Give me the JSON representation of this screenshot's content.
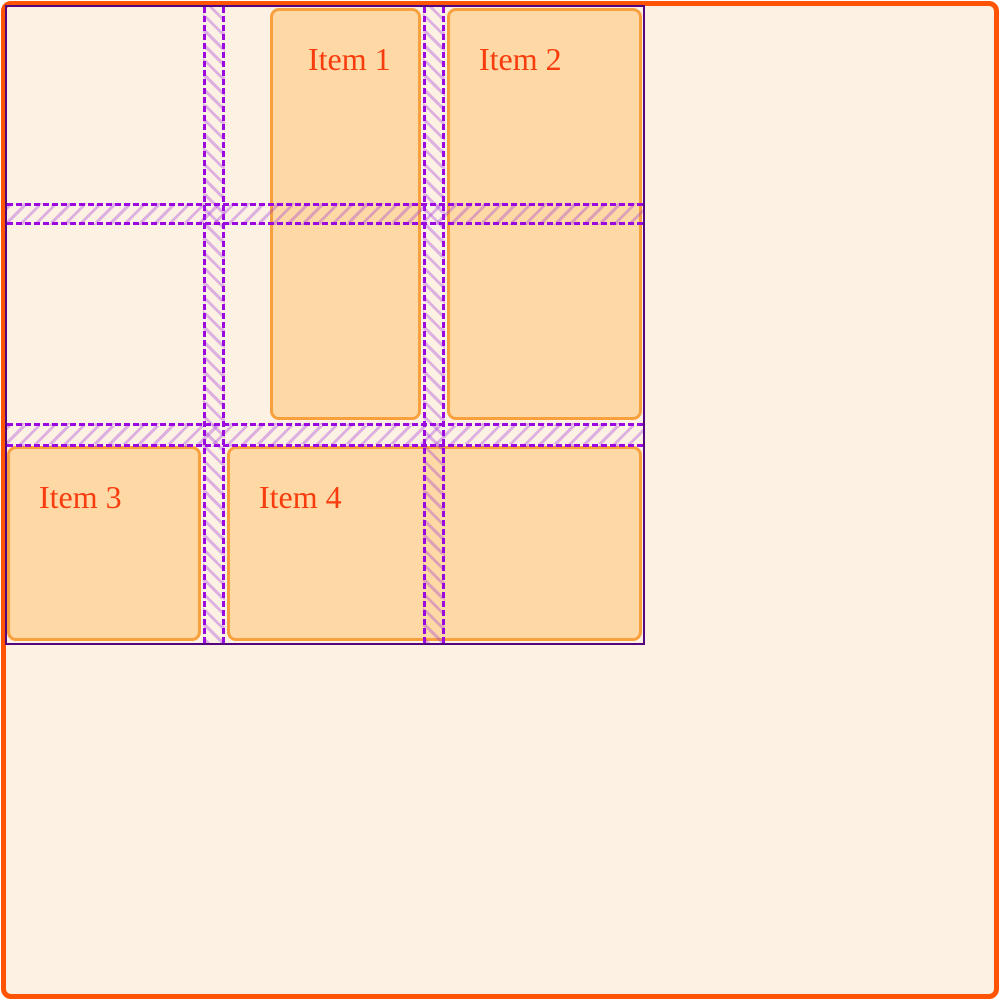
{
  "window": {
    "width": 1000,
    "height": 1000
  },
  "colors": {
    "background_outer": "#ffffff",
    "container_background": "#fdf1e3",
    "container_border_color": "#ff5404",
    "outline_color": "#55067f",
    "gridline_color": "#9c09e0",
    "gap_hatch_color": "rgba(150,40,220,0.32)",
    "item_background": "#fed8a5",
    "item_border_color": "#f9a03e",
    "item_text_color": "#f83c0d"
  },
  "grid_inspector": {
    "columns": 3,
    "rows": 3,
    "column_gaps": 2,
    "row_gaps": 2,
    "items": [
      {
        "label": "Item 1"
      },
      {
        "label": "Item 2"
      },
      {
        "label": "Item 3"
      },
      {
        "label": "Item 4"
      }
    ]
  }
}
